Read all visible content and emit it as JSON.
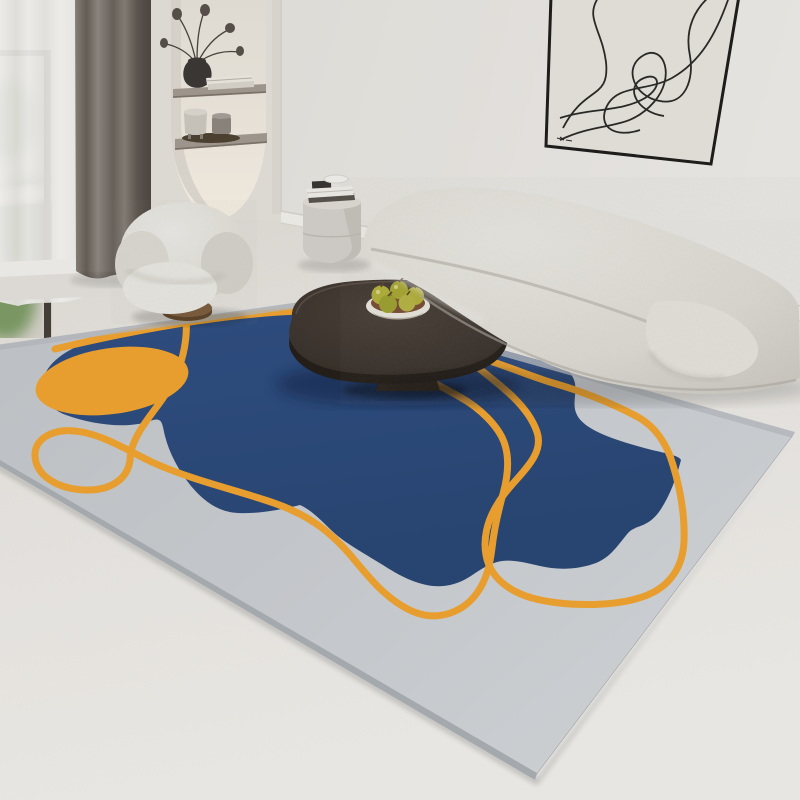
{
  "scene": {
    "title": "Modern living room with abstract geometric area rug",
    "objects": [
      "window-with-sheer-curtain",
      "gray-drape",
      "wall-niche-with-shelves",
      "dried-flower-vase",
      "stacked-books",
      "small-pots-on-tray",
      "abstract-line-art-frame",
      "curved-boucle-sofa",
      "boucle-armchair",
      "cylinder-side-table",
      "books-on-side-table",
      "dark-oval-coffee-table",
      "fruit-bowl-with-pears",
      "area-rug"
    ]
  },
  "artwork": {
    "type": "abstract-single-line-drawing",
    "signed": true
  },
  "rug_design": {
    "shapes": [
      "light-gray-field",
      "navy-organic-blob",
      "orange-ellipse",
      "two-orange-squiggle-lines"
    ],
    "pile": "low-pile printed rug shown in perspective on white floor"
  },
  "fruit": {
    "kind": "green pears",
    "count_visible": 5
  },
  "palette": {
    "wall": "#E7E4DF",
    "wall-right": "#EDEBE7",
    "niche-wall": "#E4E0DA",
    "niche-inner": "#F3EEE3",
    "shelf-wood": "#A39A90",
    "floor": "#EFECE7",
    "baseboard": "#F2F0EB",
    "sheer": "#F4F3F1",
    "drape": "#7D766F",
    "foliage": "#6F8A5C",
    "rug-base": "#C8CCD0",
    "rug-edge": "#AAAFB5",
    "rug-blue": "#2C4B7D",
    "rug-orange": "#F0A42F",
    "sofa": "#E2DFD8",
    "chair": "#E6E3DD",
    "wood-base": "#7B5B3B",
    "table-top": "#423931",
    "table-dark": "#2B241E",
    "bowl": "#ECE8E0",
    "bowl-inner": "#7A4E35",
    "pear": "#B3B13A",
    "art-canvas": "#E7E4DD",
    "art-line": "#2A2A28"
  }
}
